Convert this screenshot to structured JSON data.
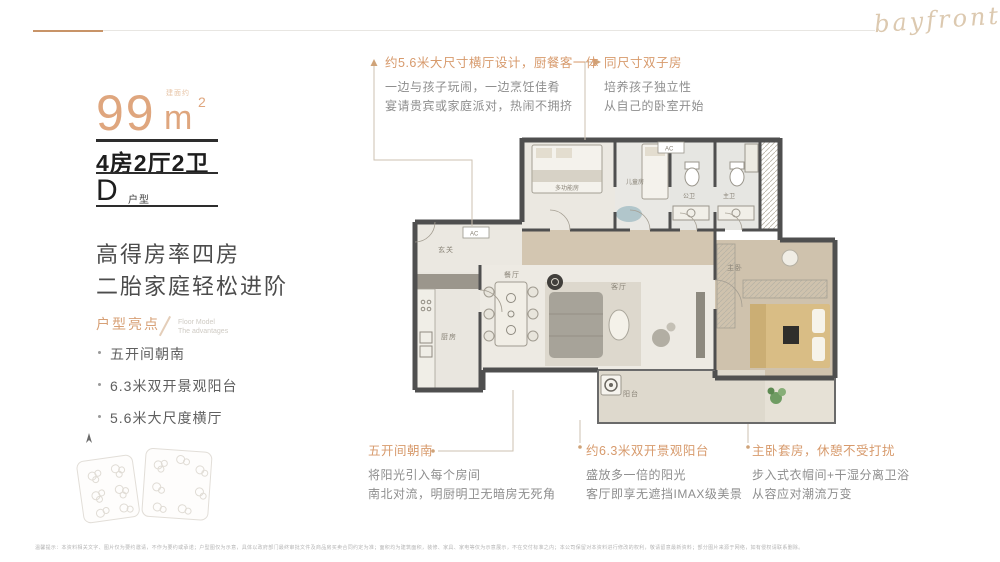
{
  "brand": {
    "script": "bayfront"
  },
  "left_panel": {
    "area_note": "建面约",
    "area_value": "99",
    "area_unit": "m",
    "area_exp": "2",
    "spec": "4房2厅2卫",
    "type_letter": "D",
    "type_suffix": "户型",
    "headline1": "高得房率四房",
    "headline2": "二胎家庭轻松进阶",
    "highlights_title": "户型亮点",
    "highlights_sub1": "Floor Model",
    "highlights_sub2": "The advantages",
    "highlights": [
      "五开间朝南",
      "6.3米双开景观阳台",
      "5.6米大尺度横厅"
    ]
  },
  "annotations": {
    "hall": {
      "title": "约5.6米大尺寸横厅设计，厨餐客一体",
      "body1": "一边与孩子玩闹，一边烹饪佳肴",
      "body2": "宴请贵宾或家庭派对，热闹不拥挤"
    },
    "twins": {
      "title": "同尺寸双子房",
      "body1": "培养孩子独立性",
      "body2": "从自己的卧室开始"
    },
    "bays": {
      "title": "五开间朝南",
      "body1": "将阳光引入每个房间",
      "body2": "南北对流，明厨明卫无暗房无死角"
    },
    "balcony": {
      "title": "约6.3米双开景观阳台",
      "body1": "盛放多一倍的阳光",
      "body2": "客厅即享无遮挡IMAX级美景"
    },
    "master": {
      "title": "主卧套房，休憩不受打扰",
      "body1": "步入式衣帽间+干湿分离卫浴",
      "body2": "从容应对潮流万变"
    }
  },
  "floorplan": {
    "rooms": {
      "entry": "玄关",
      "kitchen": "厨房",
      "dining": "餐厅",
      "living": "客厅",
      "balcony": "阳台",
      "master": "主卧",
      "kids": "儿童房",
      "multi": "多功能房",
      "bath_public": "公卫",
      "bath_master": "主卫"
    },
    "ac": "AC"
  },
  "colors": {
    "accent": "#d79a6c",
    "area": "#dfa67e"
  },
  "footer": {
    "disclaimer": "温馨提示：本资料相关文字、图片仅为要约邀请，不作为要约或承诺；户型图仅为示意，具体以政府部门最终审批文件及商品房买卖合同约定为准；面积均为建筑面积，装修、家具、家电等仅为示意展示，不在交付标准之内；本公司保留对本资料进行修改的权利，敬请留意最新资料；部分图片来源于网络，如有侵权请联系删除。"
  }
}
